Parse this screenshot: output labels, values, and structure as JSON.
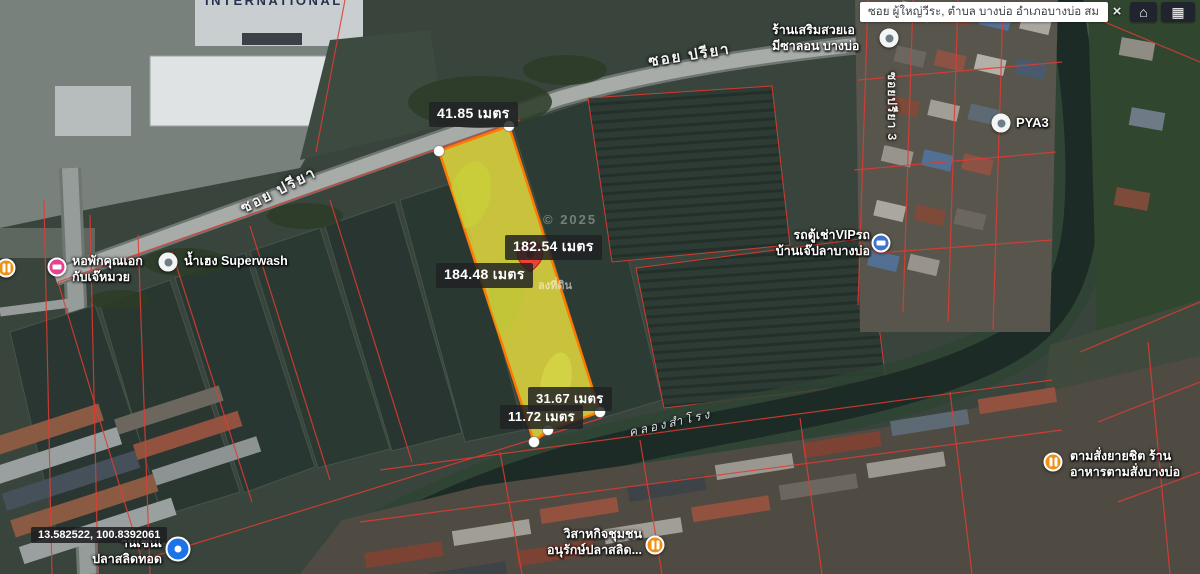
{
  "search": {
    "value": "ซอย ผู้ใหญ่วีระ, ตำบล บางบ่อ อำเภอบางบ่อ สม",
    "clear_label": "×"
  },
  "toolbar": {
    "home_icon": "⌂",
    "grid_icon": "▦"
  },
  "measurements": [
    {
      "text": "41.85 เมตร"
    },
    {
      "text": "182.54 เมตร"
    },
    {
      "text": "184.48 เมตร"
    },
    {
      "text": "31.67 เมตร"
    },
    {
      "text": "11.72 เมตร"
    }
  ],
  "coordinates": "13.582522, 100.8392061",
  "watermarks": {
    "copyright": "© 2025",
    "survey": "ลงที่ดิน"
  },
  "road_labels": {
    "soi_priya_lower": "ซอย ปรียา",
    "soi_priya_upper": "ซอย ปรียา",
    "soi_priya_3": "ซอยปรียา 3",
    "canal": "คลองสำโรง",
    "international": "INTERNATIONAL"
  },
  "pois": [
    {
      "line1": "น้ำเฮง Superwash",
      "line2": ""
    },
    {
      "line1": "หอพักคุณเอก",
      "line2": "กับเจ๊หมวย"
    },
    {
      "line1": "ร้านเสริมสวยเอ",
      "line2": "มีซาลอน บางบ่อ"
    },
    {
      "line1": "PYA3",
      "line2": ""
    },
    {
      "line1": "รถตู้เช่าVIPรถ",
      "line2": "บ้านเจ๊ปลาบางบ่อ"
    },
    {
      "line1": "ตามสั่งยายชิต ร้าน",
      "line2": "อาหารตามสั่งบางบ่อ"
    },
    {
      "line1": "วิสาหกิจชุมชน",
      "line2": "อนุรักษ์ปลาสลิด..."
    },
    {
      "line1": "านเช่นเ",
      "line2": "ปลาสลิดทอด"
    }
  ],
  "colors": {
    "plot_fill": "#f2e53e",
    "plot_stroke": "#ff7a00",
    "parcel_line": "#e23b32",
    "pin": "#ea4335"
  }
}
